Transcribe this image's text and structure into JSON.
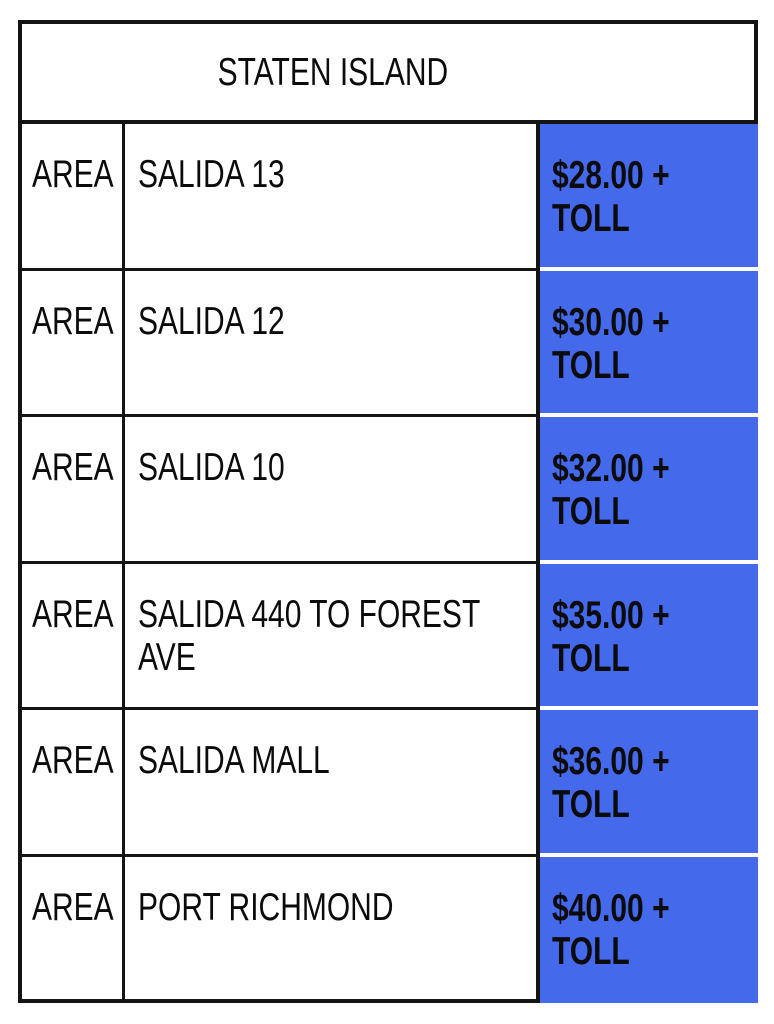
{
  "table": {
    "title": "STATEN ISLAND",
    "columns": [
      "AREA",
      "DESTINATION",
      "PRICE"
    ],
    "rows": [
      {
        "area": "AREA",
        "destination": "SALIDA 13",
        "price": "$28.00 + TOLL"
      },
      {
        "area": "AREA",
        "destination": "SALIDA 12",
        "price": "$30.00 + TOLL"
      },
      {
        "area": "AREA",
        "destination": "SALIDA 10",
        "price": "$32.00 + TOLL"
      },
      {
        "area": "AREA",
        "destination": "SALIDA 440 TO FOREST AVE",
        "price": "$35.00 + TOLL"
      },
      {
        "area": "AREA",
        "destination": "SALIDA MALL",
        "price": "$36.00 + TOLL"
      },
      {
        "area": "AREA",
        "destination": "PORT RICHMOND",
        "price": "$40.00 + TOLL"
      }
    ],
    "colors": {
      "price_cell_background": "#4569EB",
      "grid_border": "#141414",
      "text": "#0b0b0b",
      "page_background": "#ffffff"
    }
  }
}
